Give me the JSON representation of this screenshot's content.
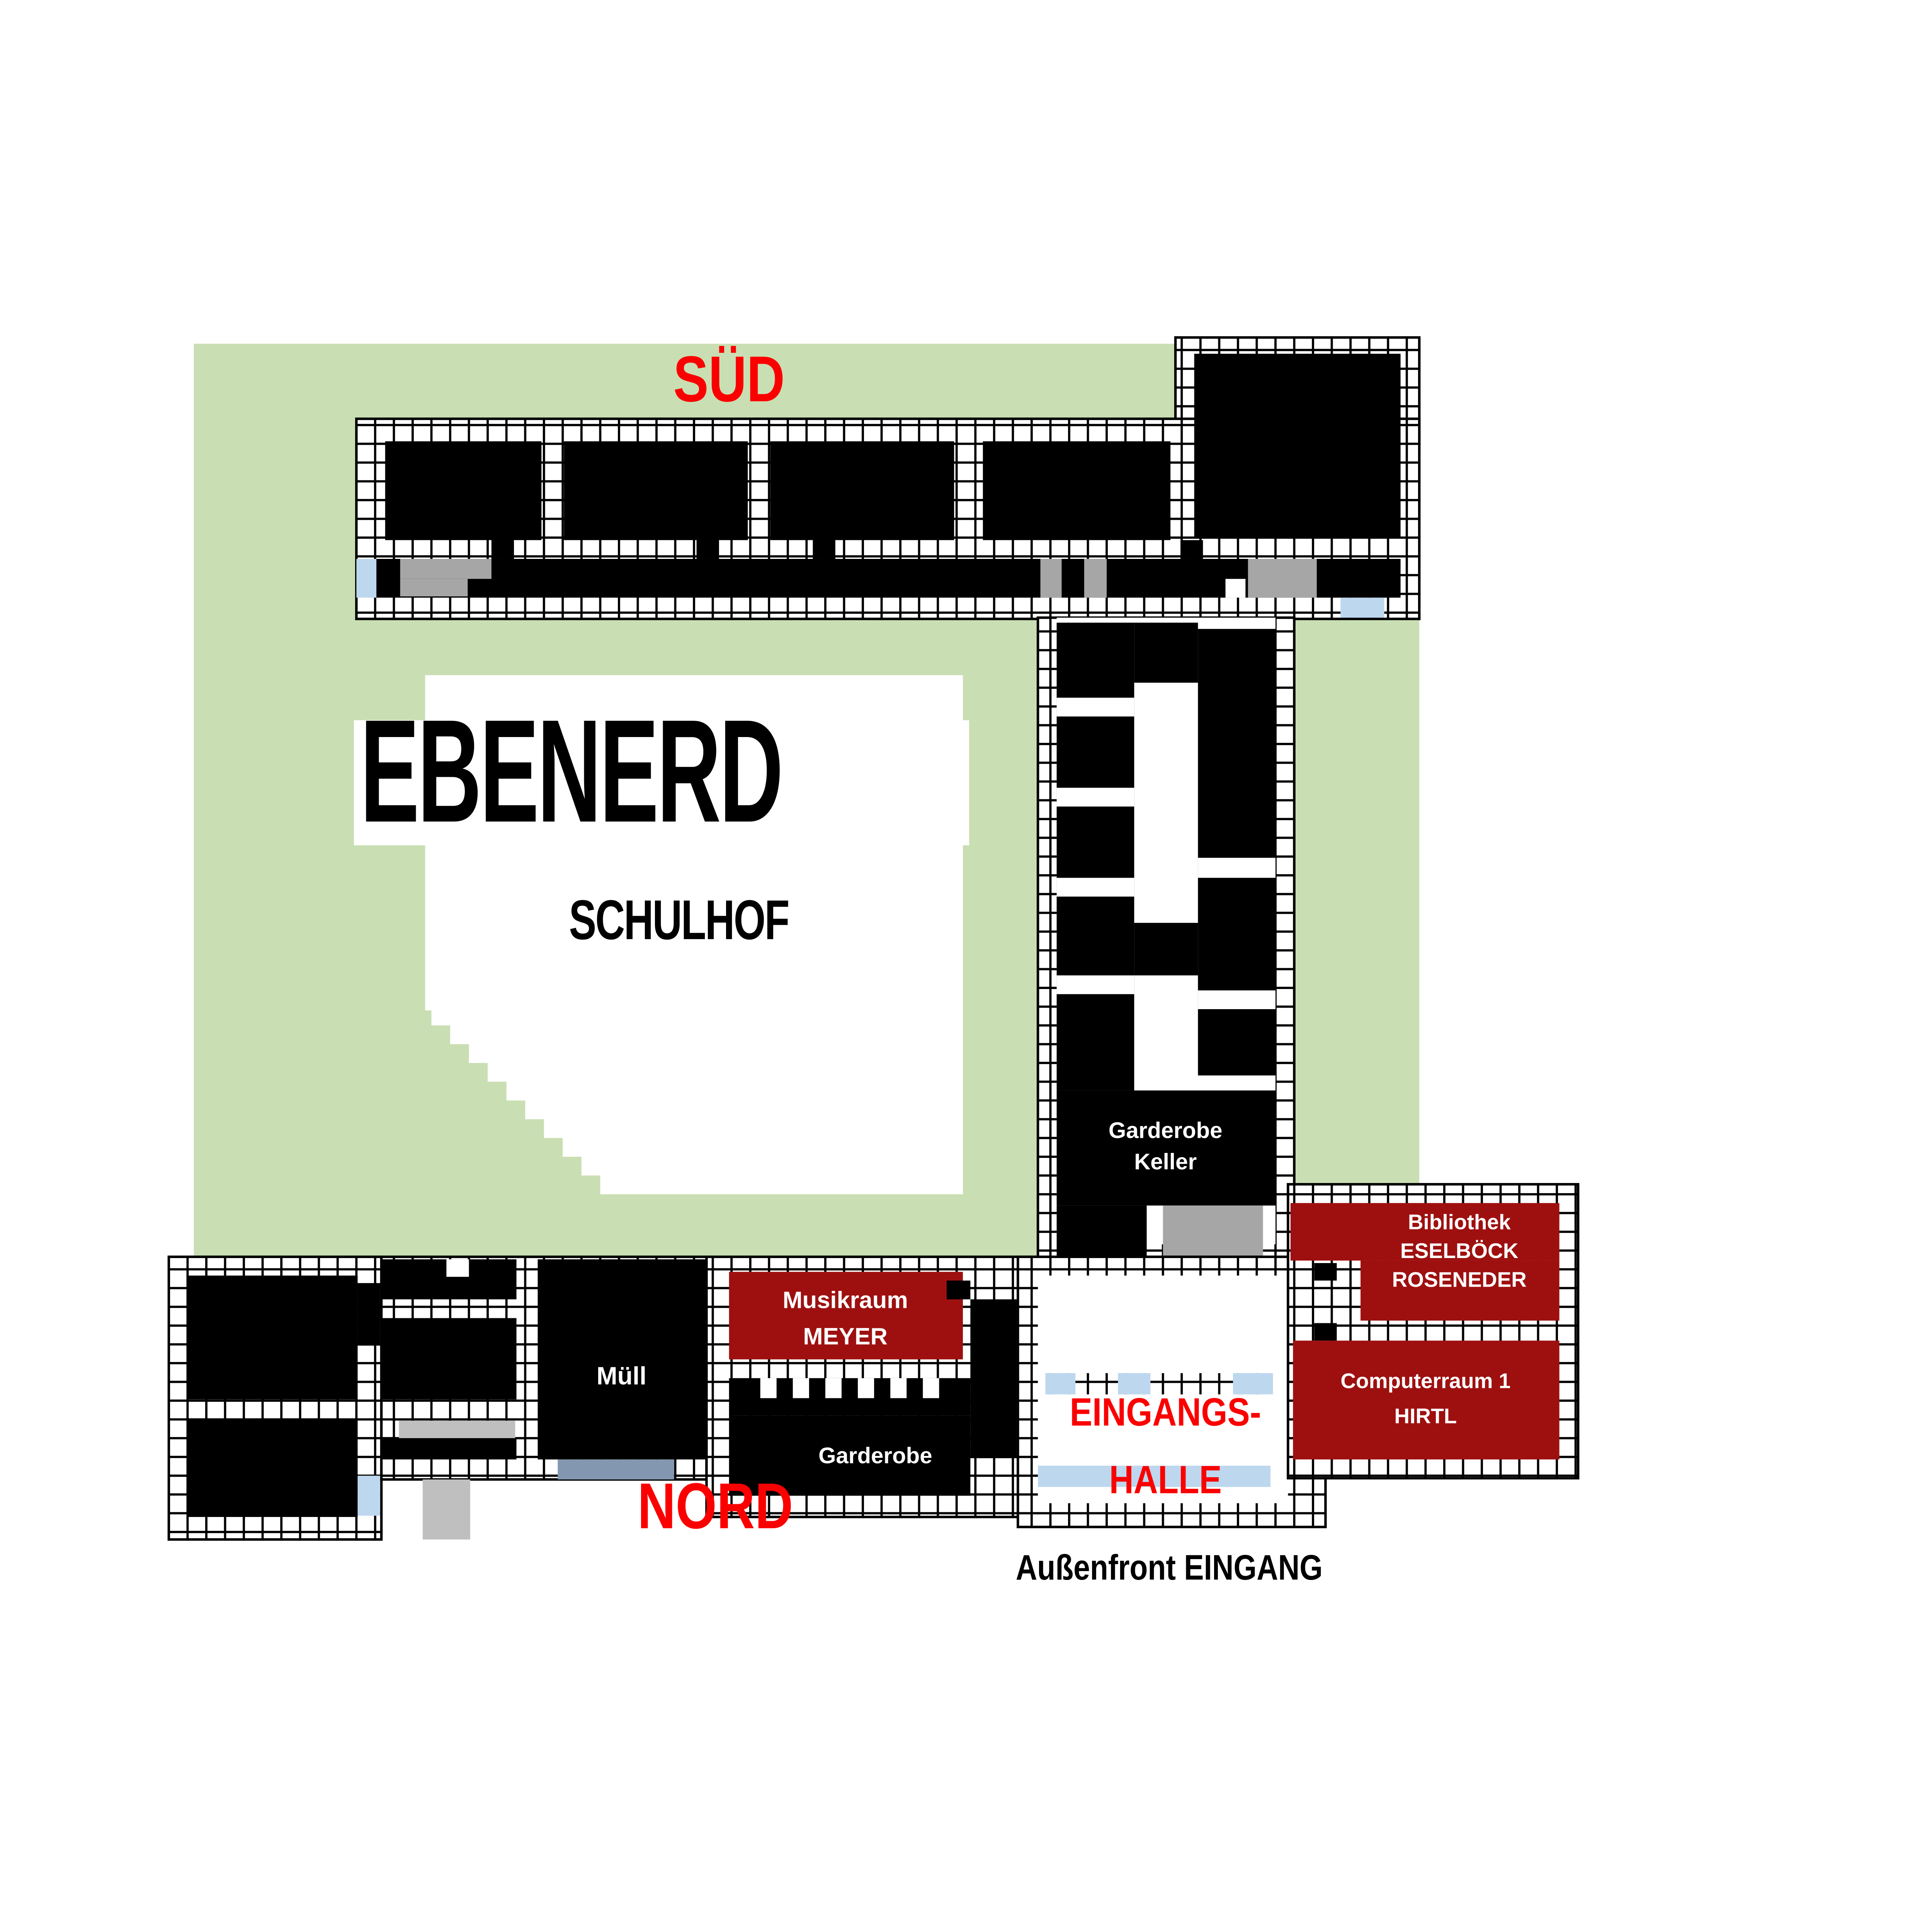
{
  "title": "Ebenerd Schul-Lageplan",
  "colors": {
    "page": "#ffffff",
    "green": "#c9dfb3",
    "wall_black": "#000000",
    "dark_red": "#9e1010",
    "bright_red": "#fb0000",
    "light_blue": "#bdd7ee",
    "blue_grey": "#8497b0",
    "grey": "#a6a6a6",
    "grey_light": "#bfbfbf",
    "white": "#ffffff"
  },
  "labels": {
    "sued": "SÜD",
    "nord": "NORD",
    "ebenerd": "EBENERD",
    "schulhof": "SCHULHOF",
    "eingangs": "EINGANGS-",
    "halle": "HALLE",
    "aussenfront": "Außenfront EINGANG"
  },
  "rooms": {
    "garderobe_keller": {
      "line1": "Garderobe",
      "line2": "Keller"
    },
    "muell": {
      "line1": "Müll"
    },
    "garderobe_nord": {
      "line1": "Garderobe"
    },
    "musikraum": {
      "line1": "Musikraum",
      "line2": "MEYER"
    },
    "bibliothek": {
      "line1": "Bibliothek",
      "line2": "ESELBÖCK",
      "line3": "ROSENEDER"
    },
    "computerraum": {
      "line1": "Computerraum 1",
      "line2": "HIRTL"
    }
  }
}
